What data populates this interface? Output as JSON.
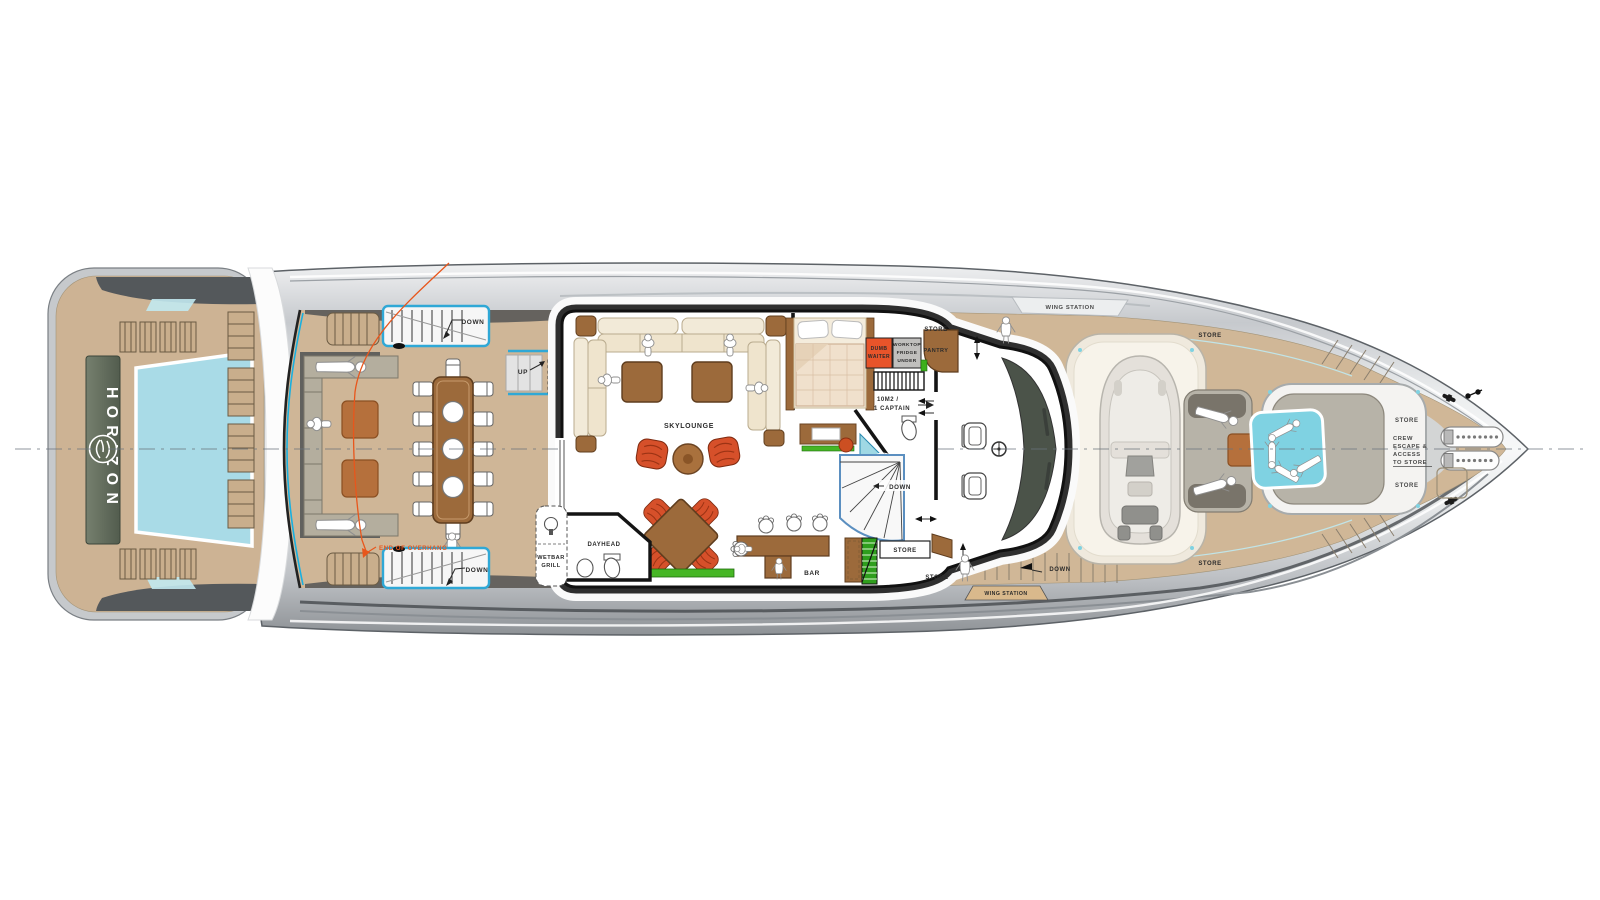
{
  "branding": {
    "name": "HORIZON"
  },
  "labels": {
    "down": "DOWN",
    "up": "UP",
    "store": "STORE",
    "icemaker": "ICEMAKER",
    "end_of_overhang": "END OF OVERHANG",
    "skylounge": "SKYLOUNGE",
    "dayhead": "DAYHEAD",
    "wetbar": [
      "WETBAR",
      "GRILL"
    ],
    "bar": "BAR",
    "dumbwaiter": [
      "DUMB",
      "WAITER"
    ],
    "worktop": [
      "WORKTOP",
      "FRIDGE",
      "UNDER"
    ],
    "pantry": "PANTRY",
    "captain_cabin": [
      "10M2 /",
      "1 CAPTAIN"
    ],
    "wing_station": "WING STATION",
    "crew_escape": [
      "CREW",
      "ESCAPE &",
      "ACCESS",
      "TO STORE"
    ]
  },
  "colors": {
    "deck_teak": "#d0b797",
    "hull_silver": "#c9ccd0",
    "pool_blue": "#a9dbe7",
    "jacuzzi_blue": "#7fd2e2",
    "furniture_brown": "#9c6a3b",
    "sofa_cream": "#f2ead8",
    "chair_red": "#d6502a",
    "accent_orange": "#e8561c",
    "planter_green": "#46b625",
    "console_green": "#4b5349",
    "annotation_ink": "#2b2b2b"
  }
}
